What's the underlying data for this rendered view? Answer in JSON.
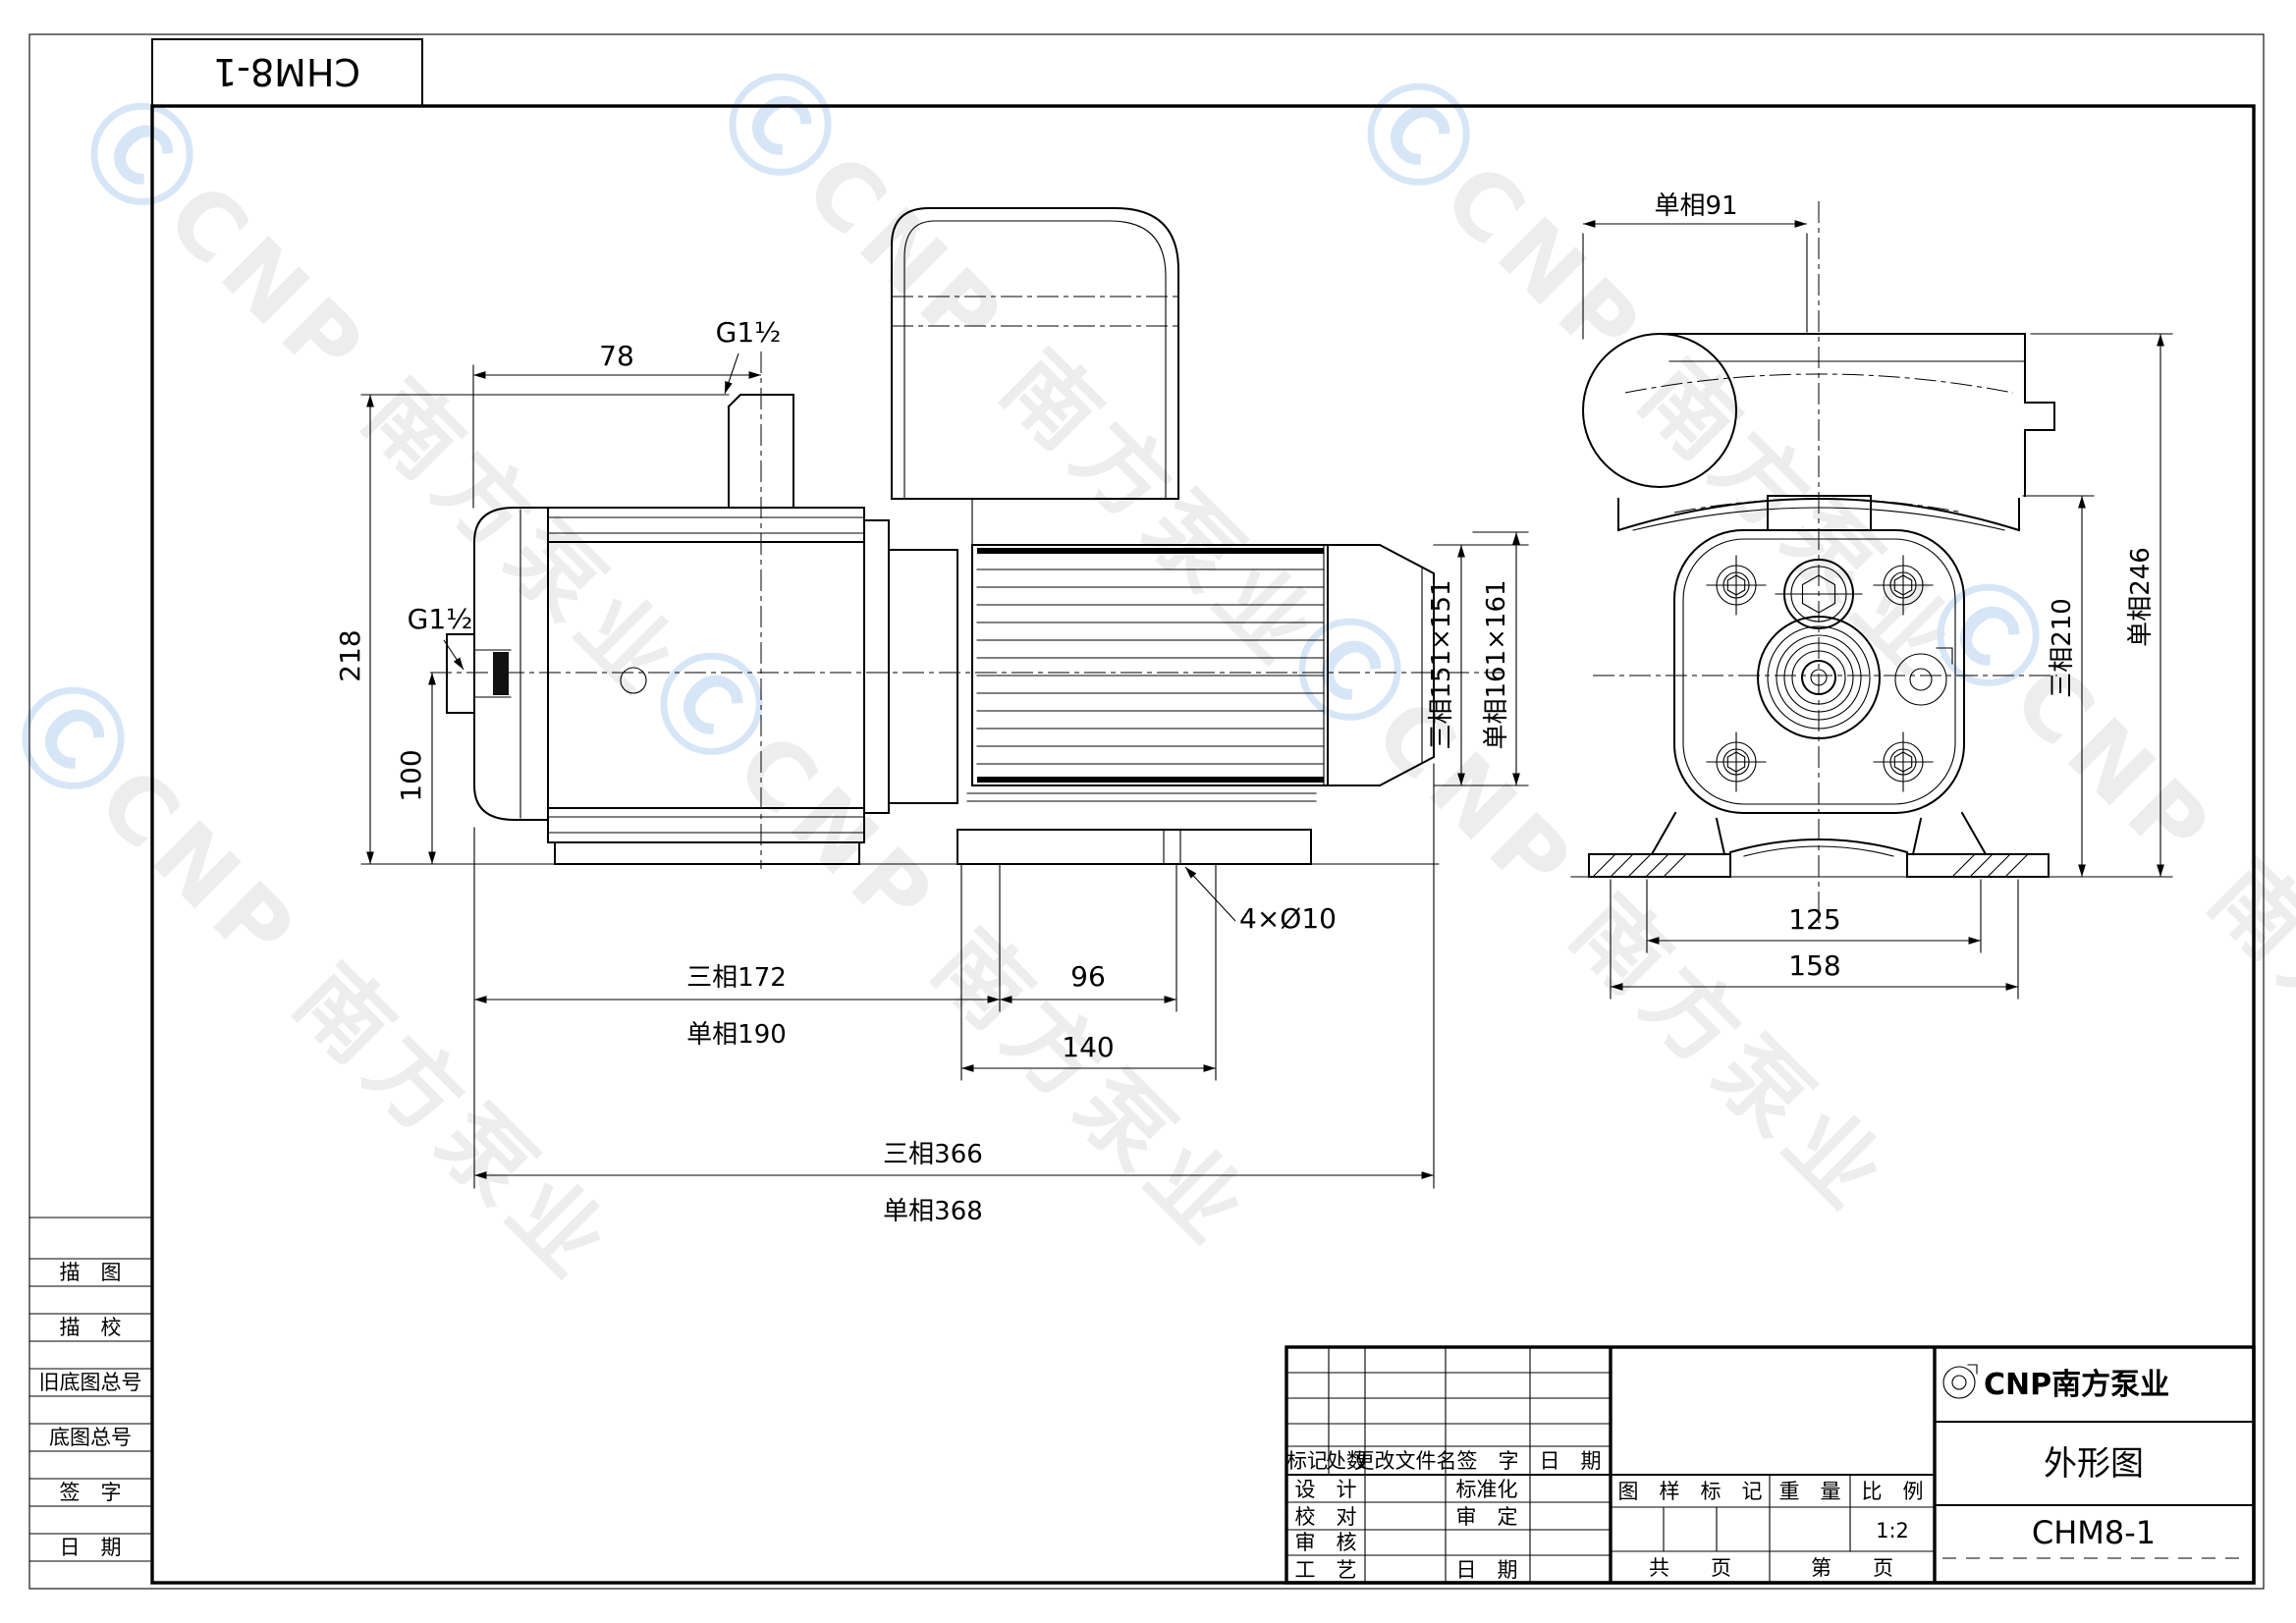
{
  "sheet": {
    "corner_model": "CHM8-1",
    "watermark": {
      "logo": "Ⓒ",
      "text": "CNP 南方泵业"
    }
  },
  "side_view": {
    "dim_78": "78",
    "port_top": "G1½",
    "port_left": "G1½",
    "dim_218": "218",
    "dim_100": "100",
    "dim_tri_172": "三相172",
    "dim_single_190": "单相190",
    "dim_96": "96",
    "dim_140": "140",
    "dim_holes": "4×Ø10",
    "dim_tri_366": "三相366",
    "dim_single_368": "单相368",
    "dim_tri_square": "三相151×151",
    "dim_single_square": "单相161×161"
  },
  "front_view": {
    "dim_single_91": "单相91",
    "dim_tri_210": "三相210",
    "dim_single_246": "单相246",
    "dim_125": "125",
    "dim_158": "158"
  },
  "sidebar": {
    "rows": [
      "描　图",
      "描　校",
      "旧底图总号",
      "底图总号",
      "签　字",
      "日　期"
    ]
  },
  "title_block": {
    "rev_header": [
      "标记",
      "处数",
      "更改文件名",
      "签　字",
      "日　期"
    ],
    "row_design": "设　计",
    "row_check": "校　对",
    "row_audit": "审　核",
    "row_process": "工　艺",
    "row_standard": "标准化",
    "row_approve": "审　定",
    "row_date": "日　期",
    "stamp_mark": "图　样　标　记",
    "stamp_weight": "重　量",
    "stamp_scale": "比　例",
    "scale_value": "1:2",
    "pages_total": "共　　页",
    "pages_no": "第　　页",
    "brand": "CNP南方泵业",
    "doc_title": "外形图",
    "model": "CHM8-1"
  }
}
